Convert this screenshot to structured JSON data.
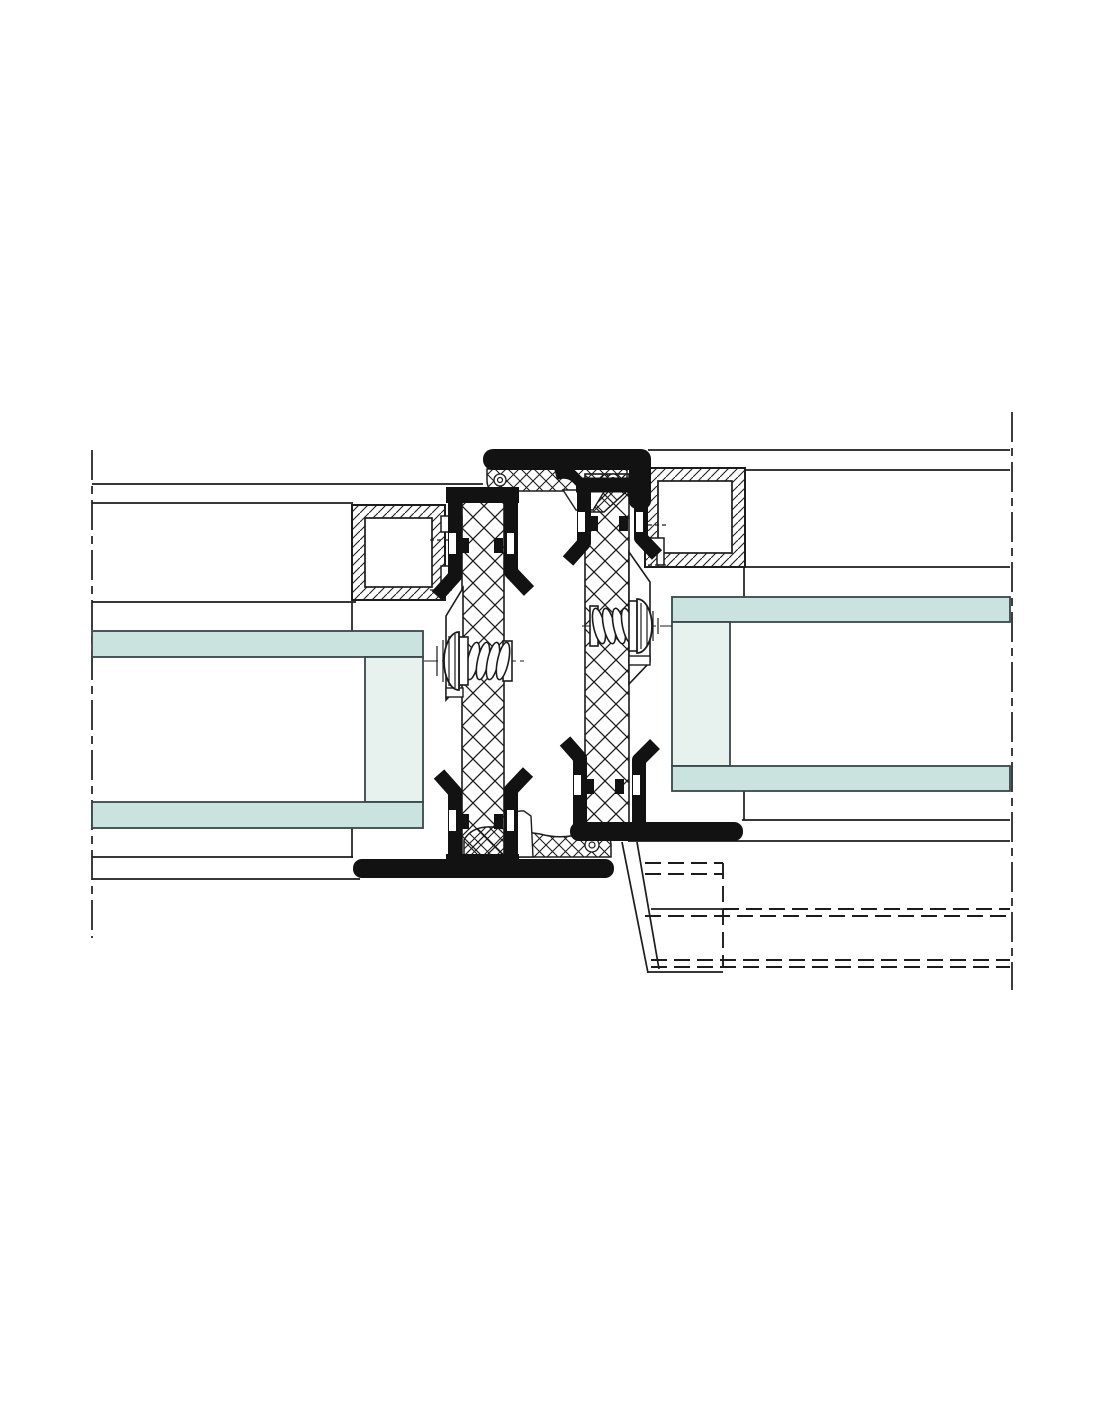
{
  "drawing": {
    "kind": "technical-section-detail",
    "description": "Cross-section CAD detail of an aluminium framed glazing mullion joint with thermal break struts, EPDM gaskets, glazing units and fixing screws",
    "visible_text": [],
    "canvas": {
      "width": 1100,
      "height": 1422,
      "background": "#ffffff"
    }
  },
  "colors": {
    "background": "#ffffff",
    "line": "#1c1c1c",
    "black_fill": "#121212",
    "glass_pane": "#cbe3df",
    "glass_spacer": "#e7f2ef",
    "glass_stroke": "#39464b",
    "white": "#ffffff"
  },
  "components": {
    "centerlines": [
      {
        "name": "left-centerline",
        "x": 92,
        "y1": 450,
        "y2": 938
      },
      {
        "name": "right-centerline",
        "x": 1012,
        "y1": 412,
        "y2": 990
      }
    ],
    "glazing": {
      "left_unit": {
        "pane_top": [
          92,
          631,
          331,
          26
        ],
        "spacer": [
          365,
          657,
          58,
          145
        ],
        "pane_bottom": [
          92,
          802,
          331,
          26
        ]
      },
      "right_unit": {
        "pane_top": [
          672,
          597,
          338,
          25
        ],
        "spacer": [
          672,
          622,
          58,
          144
        ],
        "pane_bottom": [
          672,
          766,
          338,
          25
        ]
      }
    },
    "profiles": {
      "left_glazing_bead": {
        "outer": [
          352,
          505,
          93,
          95
        ],
        "inner": [
          365,
          518,
          67,
          69
        ]
      },
      "right_glazing_bead": {
        "outer": [
          645,
          468,
          100,
          99
        ],
        "inner": [
          658,
          481,
          74,
          72
        ]
      }
    },
    "thermal_struts": {
      "left": [
        462,
        490,
        42,
        378
      ],
      "right": [
        585,
        474,
        44,
        360
      ]
    },
    "gaskets": [
      "top-cap-gasket",
      "top-center-gasket-strip",
      "bottom-center-gasket-strip",
      "top-left-clip",
      "top-right-clip",
      "bottom-left-clip",
      "bottom-right-clip",
      "bottom-left-gasket-bar",
      "bottom-right-gasket-bar"
    ],
    "screws": [
      {
        "name": "left-screw",
        "axis_y": 661,
        "head_x": 446,
        "direction": "left"
      },
      {
        "name": "right-screw",
        "axis_y": 626,
        "head_x": 648,
        "direction": "right"
      }
    ],
    "hidden_lines_region": {
      "note": "dashed hidden edges lower right",
      "x1": 645,
      "x2": 1010,
      "y1": 840,
      "y2": 973
    }
  }
}
